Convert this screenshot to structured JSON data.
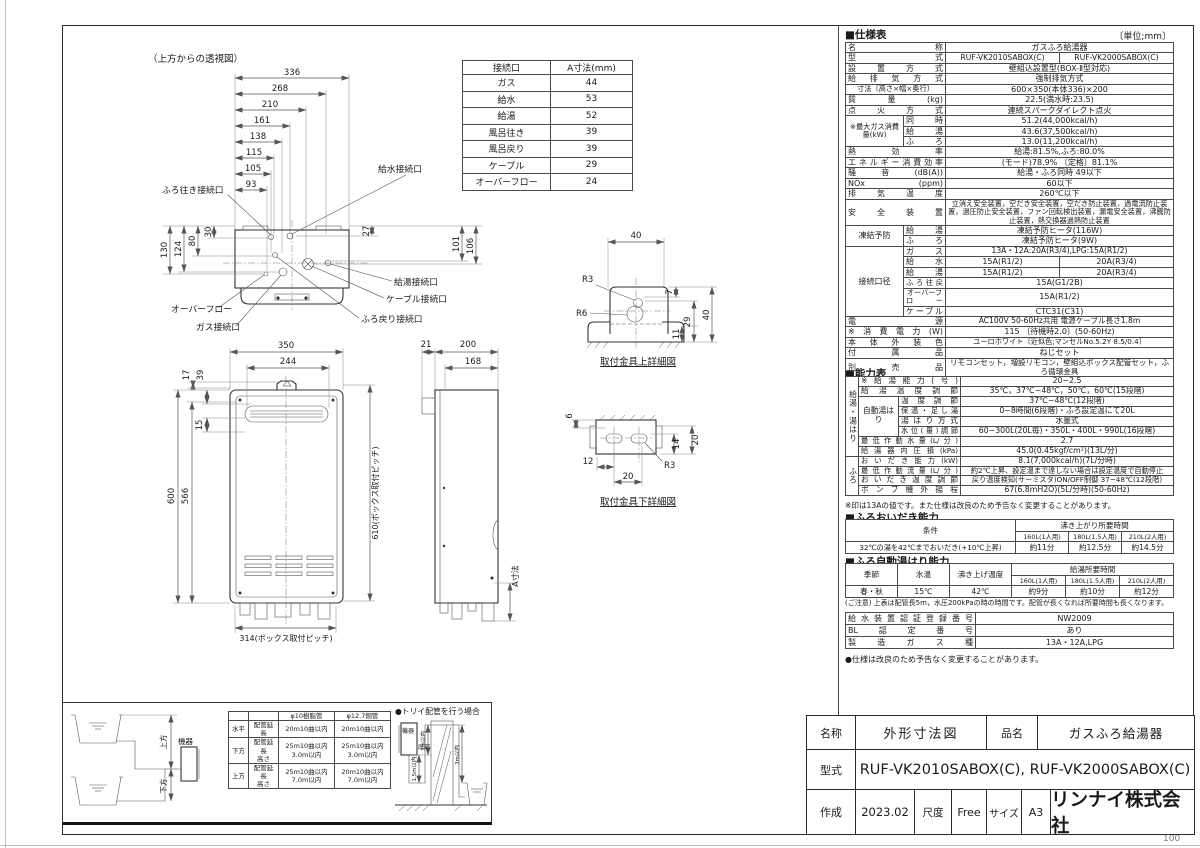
{
  "page": {
    "corner_number": "100"
  },
  "top_view": {
    "title": "（上方からの透視図）",
    "w_dims": [
      "336",
      "268",
      "210",
      "161",
      "138",
      "115",
      "105",
      "93"
    ],
    "l_dims": [
      "130",
      "124",
      "80",
      "30"
    ],
    "r_dims": [
      "27",
      "101",
      "106"
    ],
    "labels": {
      "furo_iki": "ふろ往き接続口",
      "kyusui": "給水接続口",
      "kyuto": "給湯接続口",
      "cable": "ケーブル接続口",
      "furo_modori": "ふろ戻り接続口",
      "overflow": "オーバーフロー",
      "gas": "ガス接続口"
    }
  },
  "conn_table": {
    "h1": "接続口",
    "h2": "A寸法(mm)",
    "rows": [
      [
        "ガス",
        "44"
      ],
      [
        "給水",
        "53"
      ],
      [
        "給湯",
        "52"
      ],
      [
        "風呂往き",
        "39"
      ],
      [
        "風呂戻り",
        "39"
      ],
      [
        "ケーブル",
        "29"
      ],
      [
        "オーバーフロー",
        "24"
      ]
    ]
  },
  "front_view": {
    "d350": "350",
    "d244": "244",
    "d17": "17",
    "d39": "39",
    "d15": "15",
    "d600": "600",
    "d566": "566",
    "d610": "610(ボックス取付ピッチ)",
    "d314": "314(ボックス取付ピッチ)"
  },
  "side_view": {
    "d21": "21",
    "d200": "200",
    "d168": "168",
    "da": "A寸法"
  },
  "bracket_upper": {
    "caption": "取付金具上詳細図",
    "d40w": "40",
    "r3": "R3",
    "r6": "R6",
    "d7": "7",
    "d29": "29",
    "d11": "11",
    "d40h": "40"
  },
  "bracket_lower": {
    "caption": "取付金具下詳細図",
    "d6": "6",
    "d14": "14",
    "d20r": "20",
    "d12": "12",
    "d20b": "20",
    "r3": "R3"
  },
  "piping": {
    "up": "上方",
    "down": "下方",
    "device": "機器",
    "table": {
      "c3": "φ10樹脂管",
      "c4": "φ12.7銅管",
      "rows": [
        [
          "水平",
          "配管延長",
          "20m10曲以内",
          "20m10曲以内"
        ],
        [
          "下方",
          "配管延長\n高さ",
          "25m10曲以内\n3.0m以内",
          "25m10曲以内\n3.0m以内"
        ],
        [
          "上方",
          "配管延長\n高さ",
          "25m10曲以内\n7.0m以内",
          "20m10曲以内\n7.0m以内"
        ]
      ]
    },
    "torii": {
      "title": "●トリイ配管を行う場合",
      "device": "機器",
      "bottom": "底部",
      "d3a": "3m以内",
      "d15": "1.5m以内",
      "d3b": "3m以内"
    }
  },
  "spec": {
    "title": "■仕様表",
    "unit": "〔単位;mm〕",
    "name_l": "名称",
    "name": "ガスふろ給湯器",
    "model_l": "型式",
    "model1": "RUF-VK2010SABOX(C)",
    "model2": "RUF-VK2000SABOX(C)",
    "install_l": "設置方式",
    "install": "壁組込設置型(BOX-Ⅱ型対応)",
    "vent_l": "給排気方式",
    "vent": "強制排気方式",
    "size_l": "寸法〔高さ×幅×奥行〕",
    "size": "600×350(本体336)×200",
    "weight_l": "質量(kg)",
    "weight": "22.5(満水時:23.5)",
    "ignition_l": "点火方式",
    "ignition": "連続スパークダイレクト点火",
    "gasmax_l": "※最大ガス消費量(kW)",
    "gasmax_s1": "同時",
    "gasmax_v1": "51.2(44,000kcal/h)",
    "gasmax_s2": "給湯",
    "gasmax_v2": "43.6(37,500kcal/h)",
    "gasmax_s3": "ふろ",
    "gasmax_v3": "13.0(11,200kcal/h)",
    "eff_l": "熱効率",
    "eff": "給湯:81.5%,ふろ:80.0%",
    "energy_l": "エネルギー消費効率",
    "energy": "(モード)78.9% 〔定格〕81.1%",
    "noise_l": "騒音(dB(A))",
    "noise": "給湯・ふろ同時 49以下",
    "nox_l": "NOx (ppm)",
    "nox": "60以下",
    "exhaust_l": "排気温度",
    "exhaust": "260℃以下",
    "safety_l": "安全装置",
    "safety": "立消え安全装置，空だき安全装置，空だき防止装置，過電流防止装置，過圧防止安全装置，ファン回転検出装置，漏電安全装置，沸騰防止装置，熱交換器過熱防止装置",
    "frost_l": "凍結予防",
    "frost_s1": "給湯",
    "frost_v1": "凍結予防ヒータ(116W)",
    "frost_s2": "ふろ",
    "frost_v2": "凍結予防ヒータ(9W)",
    "conn_l": "接続口径",
    "conn_s1": "ガス",
    "conn_v1": "13A・12A:20A(R3/4),LPG:15A(R1/2)",
    "conn_s2": "給水",
    "conn_v2a": "15A(R1/2)",
    "conn_v2b": "20A(R3/4)",
    "conn_s3": "給湯",
    "conn_v3a": "15A(R1/2)",
    "conn_v3b": "20A(R3/4)",
    "conn_s4": "ふろ往戻",
    "conn_v4": "15A(G1/2B)",
    "conn_s5": "オーバーフロー",
    "conn_v5": "15A(R1/2)",
    "conn_s6": "ケーブル",
    "conn_v6": "CTC31(C31)",
    "power_l": "電源",
    "power": "AC100V 50-60Hz共用 電源ケーブル長さ1.8m",
    "wattage_l": "※消費電力(W)",
    "wattage": "115 〔待機時2.0〕(50-60Hz)",
    "color_l": "本体外装色",
    "color": "ユーロホワイト〔近似色;マンセルNo.5.2Y 8.5/0.4〕",
    "accessory_l": "付属品",
    "accessory": "ねじセット",
    "optional_l": "別売品",
    "optional": "リモコンセット，増設リモコン，壁組込ボックス配管セット，ふろ循環金具"
  },
  "capacity": {
    "title": "■能力表",
    "grp1": "給湯・湯はり",
    "grp2": "ふろ",
    "r1l": "※給湯能力(号)",
    "r1": "20~2.5",
    "r2l": "給湯温度調節",
    "r2": "35℃，37℃~48℃，50℃，60℃(15段階)",
    "autol": "自動湯はり",
    "r3l": "温度調節",
    "r3": "37℃~48℃(12段階)",
    "r4l": "保温・足し湯",
    "r4": "0~8時間(6段階)・ふろ設定温にて20L",
    "r5l": "湯はり方式",
    "r5": "水量式",
    "r6l": "水位(量)調節",
    "r6": "60~300L(20L毎)・350L・400L・990L(16段階)",
    "r7l": "最低作動水量(L/分)",
    "r7": "2.7",
    "r8l": "給湯器内圧損(kPa)",
    "r8": "45.0(0.45kgf/cm²)(13L/分)",
    "r9l": "おいだき能力(kW)",
    "r9": "8.1(7,000kcal/h)(7L/分時)",
    "r10l": "最低作動流量(L/分)",
    "r10": "約2℃上昇、設定温まで達しない場合は設定温度で自動停止",
    "r11l": "おいだき温度調節",
    "r11": "戻り温度検知(サーミスタ)ON/OFF制御 37~48℃(12段階)",
    "r12l": "ポンプ機外揚程",
    "r12": "67(6.8mH2O)(5L/分時)(50-60Hz)",
    "footnote": "※印は13Aの値です。また仕様は改良のため予告なく変更することがあります。"
  },
  "reheat": {
    "title": "■ふろおいだき能力",
    "cond": "条件",
    "time_h": "沸き上がり所要時間",
    "c1": "160L(1人用)",
    "c2": "180L(1.5人用)",
    "c3": "210L(2人用)",
    "cond_v": "32℃の湯を42℃までおいだき(+10℃上昇)",
    "v1": "約11分",
    "v2": "約12.5分",
    "v3": "約14.5分"
  },
  "autofill": {
    "title": "■ふろ自動湯はり能力",
    "season": "季節",
    "temp": "水温",
    "target": "沸き上げ温度",
    "time_h": "給湯所要時間",
    "c1": "160L(1人用)",
    "c2": "180L(1.5人用)",
    "c3": "210L(2人用)",
    "season_v": "春・秋",
    "temp_v": "15℃",
    "target_v": "42℃",
    "v1": "約9分",
    "v2": "約10分",
    "v3": "約12分",
    "note": "(ご注意) 上表は配管長5m，水圧200kPaの時の時間です。配管が長くなれば所要時間も長くなります。"
  },
  "cert": {
    "r1l": "給水装置認証登録番号",
    "r1": "NW2009",
    "r2l": "BL認定番号",
    "r2": "あり",
    "r3l": "製造ガス種",
    "r3": "13A・12A,LPG"
  },
  "spec_note": "●仕様は改良のため予告なく変更することがあります。",
  "title_block": {
    "name_l": "名称",
    "name": "外形寸法図",
    "item_l": "品名",
    "item": "ガスふろ給湯器",
    "model_l": "型式",
    "model": "RUF-VK2010SABOX(C), RUF-VK2000SABOX(C)",
    "date_l": "作成",
    "date": "2023.02",
    "scale_l": "尺度",
    "scale": "Free",
    "size_l": "サイズ",
    "size": "A3",
    "company": "リンナイ株式会社"
  }
}
